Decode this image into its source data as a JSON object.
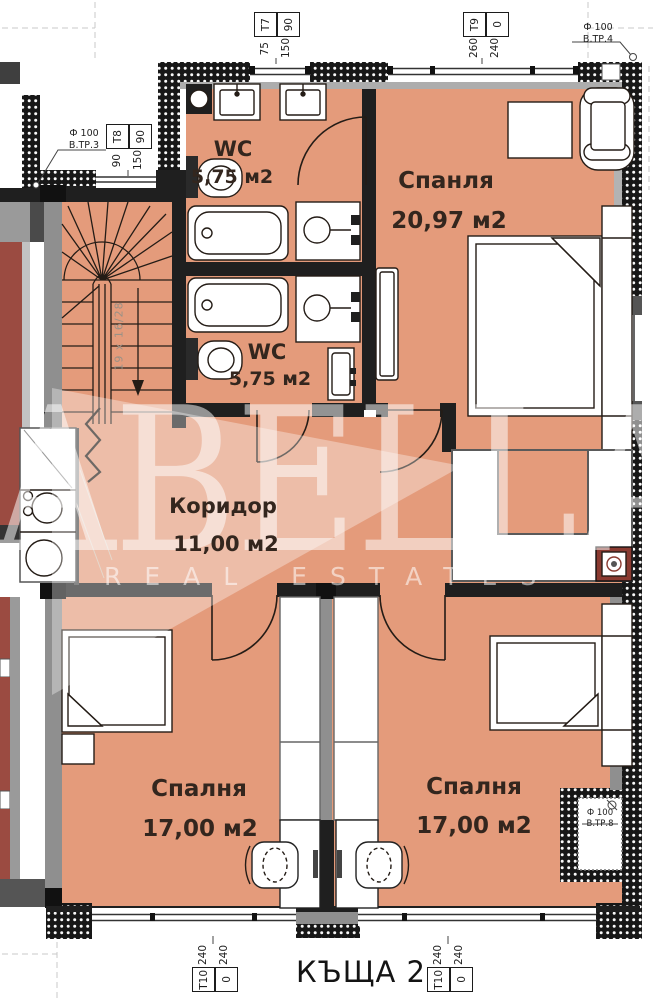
{
  "plan_title": "КЪЩА 2",
  "watermark": {
    "brand": "ABELLA",
    "tagline": "REAL ESTATES"
  },
  "rooms": {
    "wc_top": {
      "name": "WC",
      "area": "5,75 м2"
    },
    "wc_bottom": {
      "name": "WC",
      "area": "5,75 м2"
    },
    "bedroom_top": {
      "name": "Спанля",
      "area": "20,97 м2"
    },
    "corridor": {
      "name": "Коридор",
      "area": "11,00 м2"
    },
    "bedroom_left": {
      "name": "Спалня",
      "area": "17,00 м2"
    },
    "bedroom_right": {
      "name": "Спалня",
      "area": "17,00 м2"
    }
  },
  "stairs": {
    "dimension_note": "19 х 16/28"
  },
  "window_tags": {
    "t7": {
      "type": "Т7",
      "width": "75",
      "height": "150",
      "sill": "90"
    },
    "t8": {
      "type": "Т8",
      "width": "90",
      "height": "150",
      "sill": "90"
    },
    "t9": {
      "type": "Т9",
      "width": "260",
      "height": "240",
      "sill": "0"
    },
    "t10_left": {
      "type": "Т10",
      "width": "240",
      "height": "240",
      "sill": "0"
    },
    "t10_right": {
      "type": "Т10",
      "width": "240",
      "height": "240",
      "sill": "0"
    }
  },
  "vents": {
    "vtr3": {
      "size": "Ф 100",
      "label": "В.ТР.3"
    },
    "vtr4": {
      "size": "Ф 100",
      "label": "В.ТР.4"
    },
    "vtr8": {
      "size": "Ф 100",
      "label": "В.ТР.8"
    }
  },
  "colors": {
    "floor": "#e49b7b",
    "neighbor_floor": "#9b4b41",
    "wall_dark": "#1b1b1b",
    "wall_grey": "#8f8f8f",
    "label_text": "#33261e",
    "chimney": "#8a3a30"
  }
}
